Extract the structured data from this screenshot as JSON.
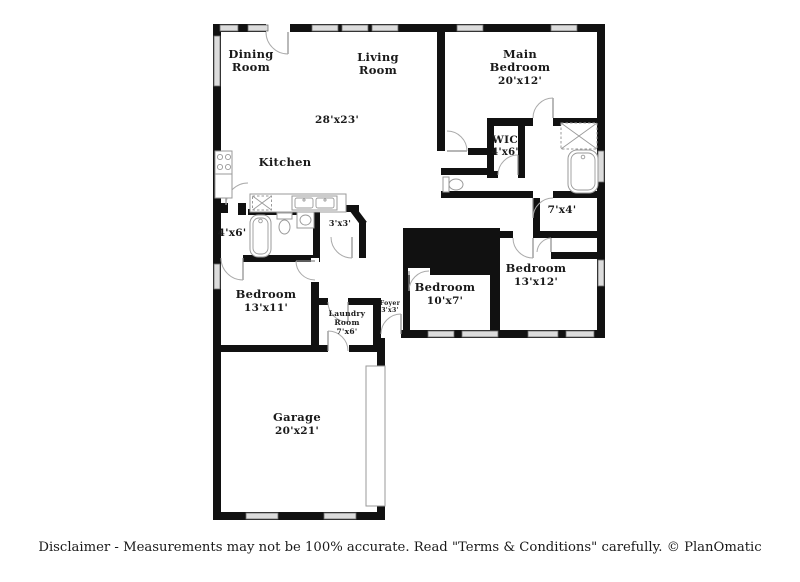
{
  "colors": {
    "wall": "#111111",
    "window-fill": "#dcdcdc",
    "window-stroke": "#6b6b6b",
    "fixture": "#9a9a9a",
    "door": "#aaaaaa",
    "label": "#1a1a1a",
    "bg": "#ffffff"
  },
  "rooms": {
    "dining": {
      "line1": "Dining",
      "line2": "Room"
    },
    "living": {
      "line1": "Living",
      "line2": "Room",
      "dims": "28'x23'"
    },
    "main_bedroom": {
      "line1": "Main",
      "line2": "Bedroom",
      "dims": "20'x12'"
    },
    "wic": {
      "name": "WIC",
      "dims": "4'x6'"
    },
    "kitchen": {
      "name": "Kitchen"
    },
    "hall_bath": {
      "dims": "4'x6'"
    },
    "pantry": {
      "dims": "3'x3'"
    },
    "hall": {
      "dims": "7'x4'"
    },
    "bedroom2": {
      "name": "Bedroom",
      "dims": "13'x11'"
    },
    "bedroom3": {
      "name": "Bedroom",
      "dims": "10'x7'"
    },
    "bedroom4": {
      "name": "Bedroom",
      "dims": "13'x12'"
    },
    "laundry": {
      "line1": "Laundry",
      "line2": "Room",
      "dims": "7'x6'"
    },
    "foyer": {
      "name": "Foyer",
      "dims": "3'x3'"
    },
    "garage": {
      "name": "Garage",
      "dims": "20'x21'"
    }
  },
  "footer": {
    "disclaimer": "Disclaimer - Measurements may not be 100% accurate. Read \"Terms & Conditions\" carefully. © PlanOmatic"
  }
}
